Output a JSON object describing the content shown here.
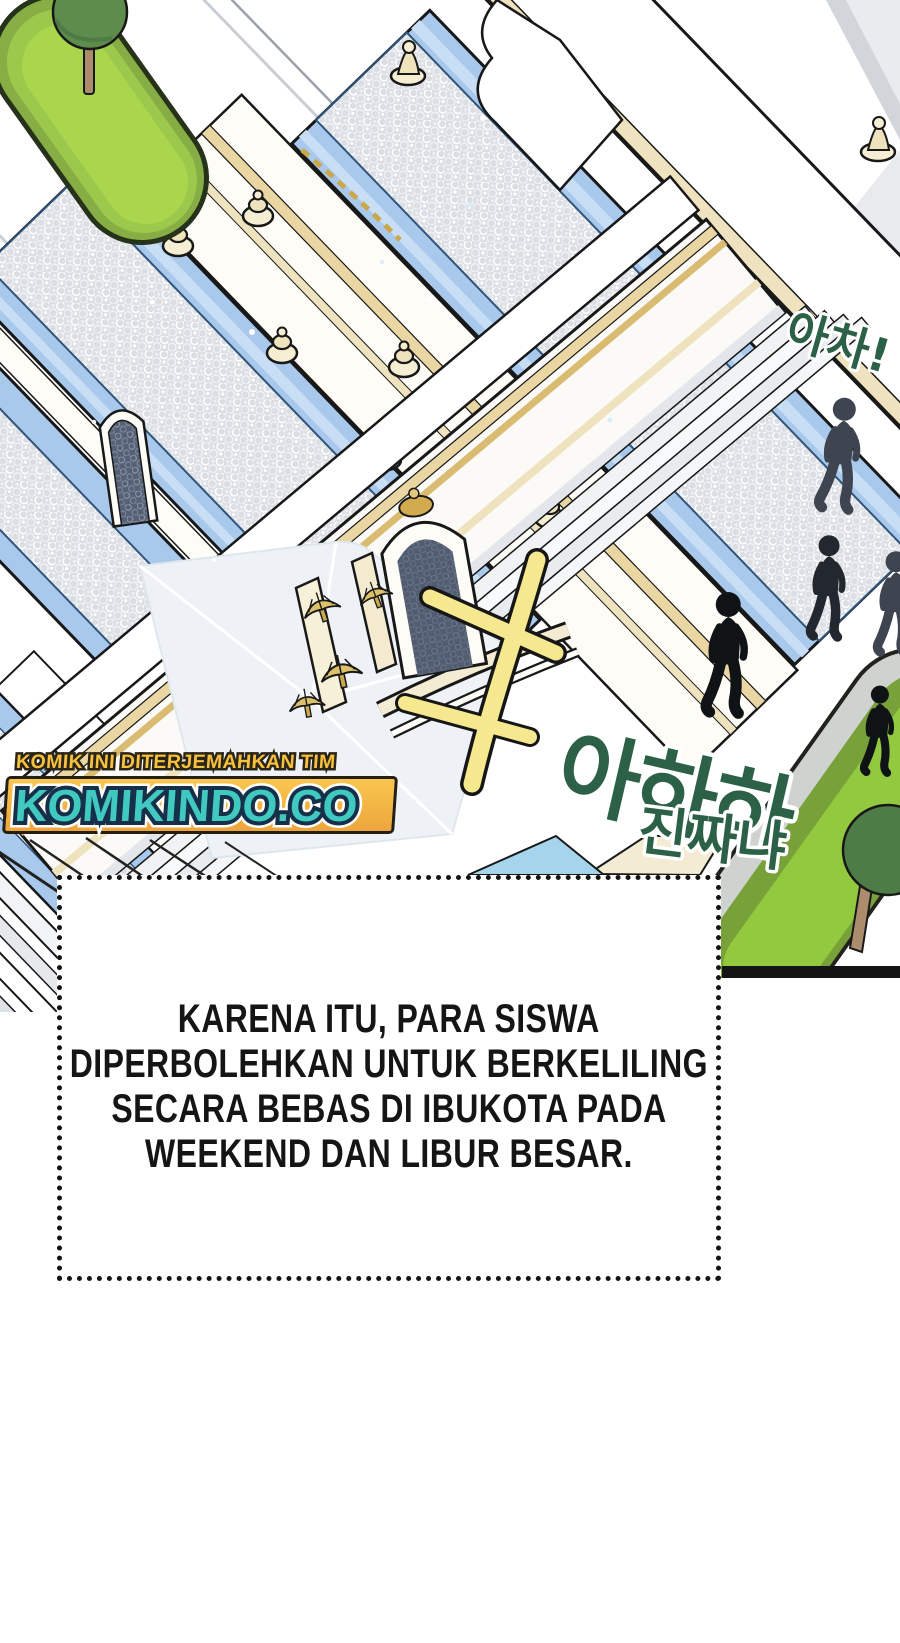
{
  "sfx": {
    "oops": "아차!",
    "laugh_big": "아하하",
    "laugh_small": "진짜냐"
  },
  "watermark": {
    "credit_line": "KOMIK INI DITERJEMAHKAN TIM",
    "site_name": "KOMIKINDO.CO"
  },
  "narration": {
    "lines": [
      "KARENA ITU, PARA SISWA",
      "DIPERBOLEHKAN UNTUK BERKELILING",
      "SECARA BEBAS DI IBUKOTA PADA",
      "WEEKEND DAN LIBUR BESAR."
    ]
  },
  "colors": {
    "sfx_text_green": "#2c6148",
    "sfx_mark_yellow": "#f5e88f",
    "roof_blue": "#a9c9ec",
    "mosaic_grey": "#dbdee3",
    "lawn_green": "#a9d64c",
    "lawn_border_olive": "#87ae45",
    "tree_green": "#5d8c4d",
    "silhouette_dark": "#23272e",
    "watermark_band_yellow": "#f5b945",
    "watermark_site_teal": "#3fc9c1",
    "watermark_credit_yellow": "#f6c13e",
    "watermark_outline_navy": "#173049",
    "outline_black": "#181818"
  }
}
